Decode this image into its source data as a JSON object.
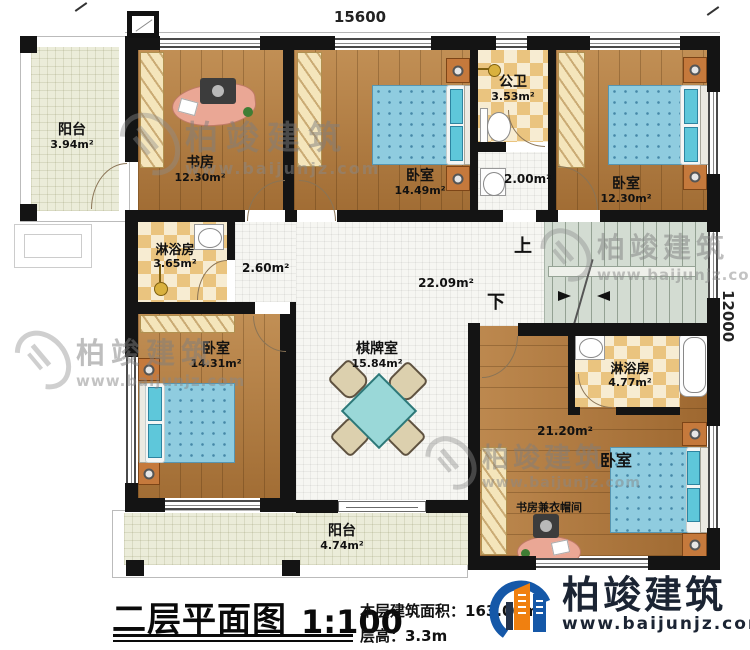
{
  "dimensions": {
    "top": "15600",
    "right": "12000"
  },
  "stairs": {
    "up": "上",
    "down": "下"
  },
  "rooms": {
    "balcony_top": {
      "name": "阳台",
      "area": "3.94m²"
    },
    "study": {
      "name": "书房",
      "area": "12.30m²"
    },
    "bedroom_top_mid": {
      "name": "卧室",
      "area": "14.49m²"
    },
    "public_bath": {
      "name": "公卫",
      "area": "3.53m²"
    },
    "vestibule": {
      "area": "2.00m²"
    },
    "bedroom_top_right": {
      "name": "卧室",
      "area": "12.30m²"
    },
    "shower_left": {
      "name": "淋浴房",
      "area": "3.65m²"
    },
    "corridor": {
      "area": "2.60m²"
    },
    "hall": {
      "area": "22.09m²"
    },
    "bedroom_left": {
      "name": "卧室",
      "area": "14.31m²"
    },
    "game_room": {
      "name": "棋牌室",
      "area": "15.84m²"
    },
    "shower_right": {
      "name": "淋浴房",
      "area": "4.77m²"
    },
    "bedroom_bottom_right": {
      "name": "卧室",
      "area": "21.20m²",
      "sub": "书房兼衣帽间"
    },
    "balcony_bottom": {
      "name": "阳台",
      "area": "4.74m²"
    }
  },
  "title": {
    "text": "二层平面图",
    "scale": "1:100",
    "floor_area": "本层建筑面积：163.00m²",
    "floor_height": "层高：3.3m"
  },
  "brand": {
    "name": "柏竣建筑",
    "url": "www.baijunjz.com"
  },
  "watermark": {
    "name": "柏竣建筑",
    "url": "www.baijunjz.com"
  },
  "colors": {
    "wall": "#141414",
    "wood": "#b27a3d",
    "tile_tan": "#eac47f",
    "stair": "#d3dcd2",
    "bed": "#8fccdf",
    "brand_blue": "#1558a8",
    "brand_orange": "#f08010"
  }
}
